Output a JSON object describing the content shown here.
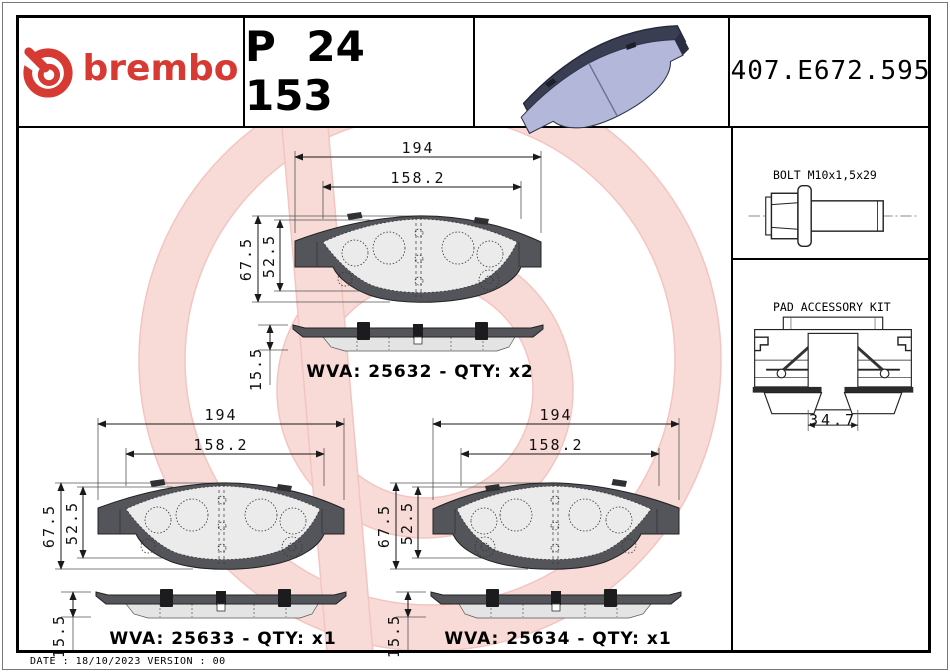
{
  "header": {
    "brand_logo": "brembo",
    "part_number": "P 24 153",
    "reference_code": "407.E672.595"
  },
  "sidebar": {
    "bolt_box": {
      "title": "BOLT M10x1,5x29",
      "code_line": "05.E659.013 - x2",
      "icon": "flange-hex-bolt-diagram"
    },
    "accessory_box": {
      "title": "PAD ACCESSORY KIT",
      "code_line": "07.E658.071 - x1",
      "width_dim": "34.7",
      "icon": "pad-accessory-kit-diagram"
    }
  },
  "drawings": [
    {
      "overall_width": "194",
      "pad_width": "158.2",
      "overall_height": "67.5",
      "pad_height": "52.5",
      "thickness": "15.5",
      "wva_line": "WVA: 25632 - QTY: x2"
    },
    {
      "overall_width": "194",
      "pad_width": "158.2",
      "overall_height": "67.5",
      "pad_height": "52.5",
      "thickness": "15.5",
      "wva_line": "WVA: 25633 - QTY: x1"
    },
    {
      "overall_width": "194",
      "pad_width": "158.2",
      "overall_height": "67.5",
      "pad_height": "52.5",
      "thickness": "15.5",
      "wva_line": "WVA: 25634 - QTY: x1"
    }
  ],
  "footer": {
    "date_version": "DATE : 18/10/2023 VERSION : 00"
  },
  "colors": {
    "brand_red": "#d63a32",
    "watermark_pink": "#f7d2ce",
    "backplate_gray": "#54555a",
    "friction_gray": "#ebebeb",
    "pad_3d_blue": "#b3b7d9"
  }
}
